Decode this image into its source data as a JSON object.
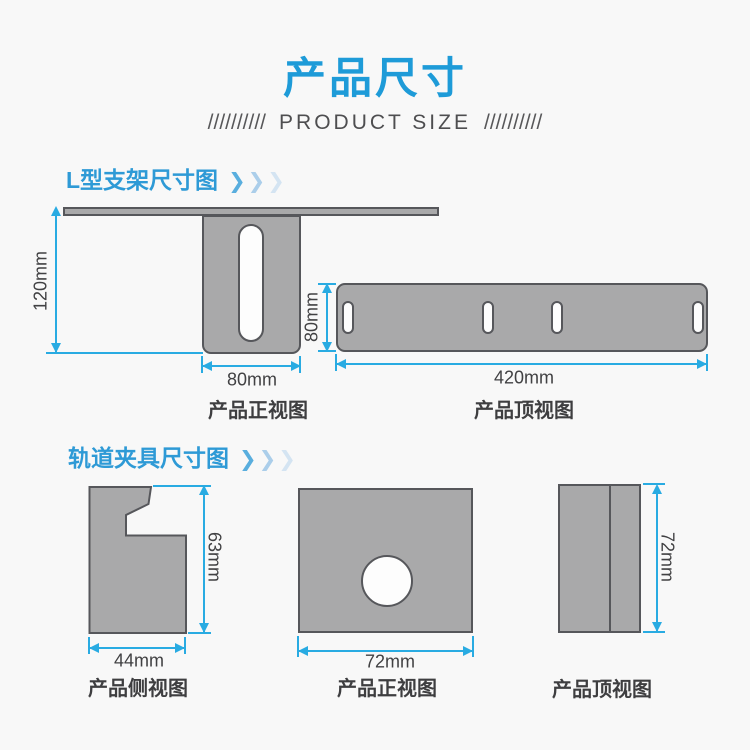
{
  "header": {
    "title": "产品尺寸",
    "subtitle_left": "//////////",
    "subtitle_text": "PRODUCT SIZE",
    "subtitle_right": "//////////"
  },
  "icons": {
    "chevron": "❯"
  },
  "colors": {
    "title_blue": "#1e9bd8",
    "heading_blue": "#2e9ad6",
    "dimension_cyan": "#29abe2",
    "shape_gray": "#a9a9aa",
    "shape_stroke": "#56575b",
    "background": "#f8f8f8"
  },
  "sections": [
    {
      "heading": "L型支架尺寸图",
      "figures": [
        {
          "caption": "产品正视图",
          "height_label": "120mm",
          "width_label": "80mm"
        },
        {
          "caption": "产品顶视图",
          "height_label": "80mm",
          "width_label": "420mm"
        }
      ]
    },
    {
      "heading": "轨道夹具尺寸图",
      "figures": [
        {
          "caption": "产品侧视图",
          "height_label": "63mm",
          "width_label": "44mm"
        },
        {
          "caption": "产品正视图",
          "width_label": "72mm"
        },
        {
          "caption": "产品顶视图",
          "height_label": "72mm"
        }
      ]
    }
  ]
}
